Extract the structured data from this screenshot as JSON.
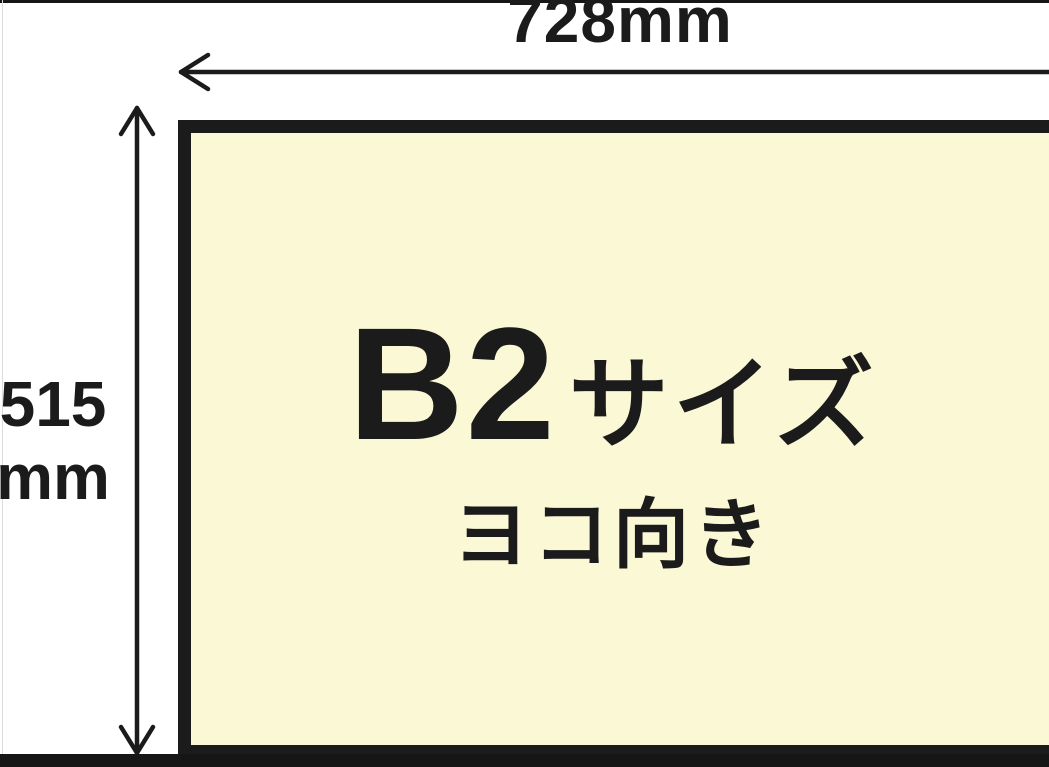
{
  "diagram": {
    "paper": {
      "size_main": "B2",
      "size_suffix": "サイズ",
      "orientation": "ヨコ向き"
    },
    "dimensions": {
      "width_label": "728mm",
      "height_value": "515",
      "height_unit": "mm"
    },
    "colors": {
      "paper_fill": "#FBF8D6",
      "ink": "#1B1B1B",
      "background": "#FFFFFF"
    }
  }
}
